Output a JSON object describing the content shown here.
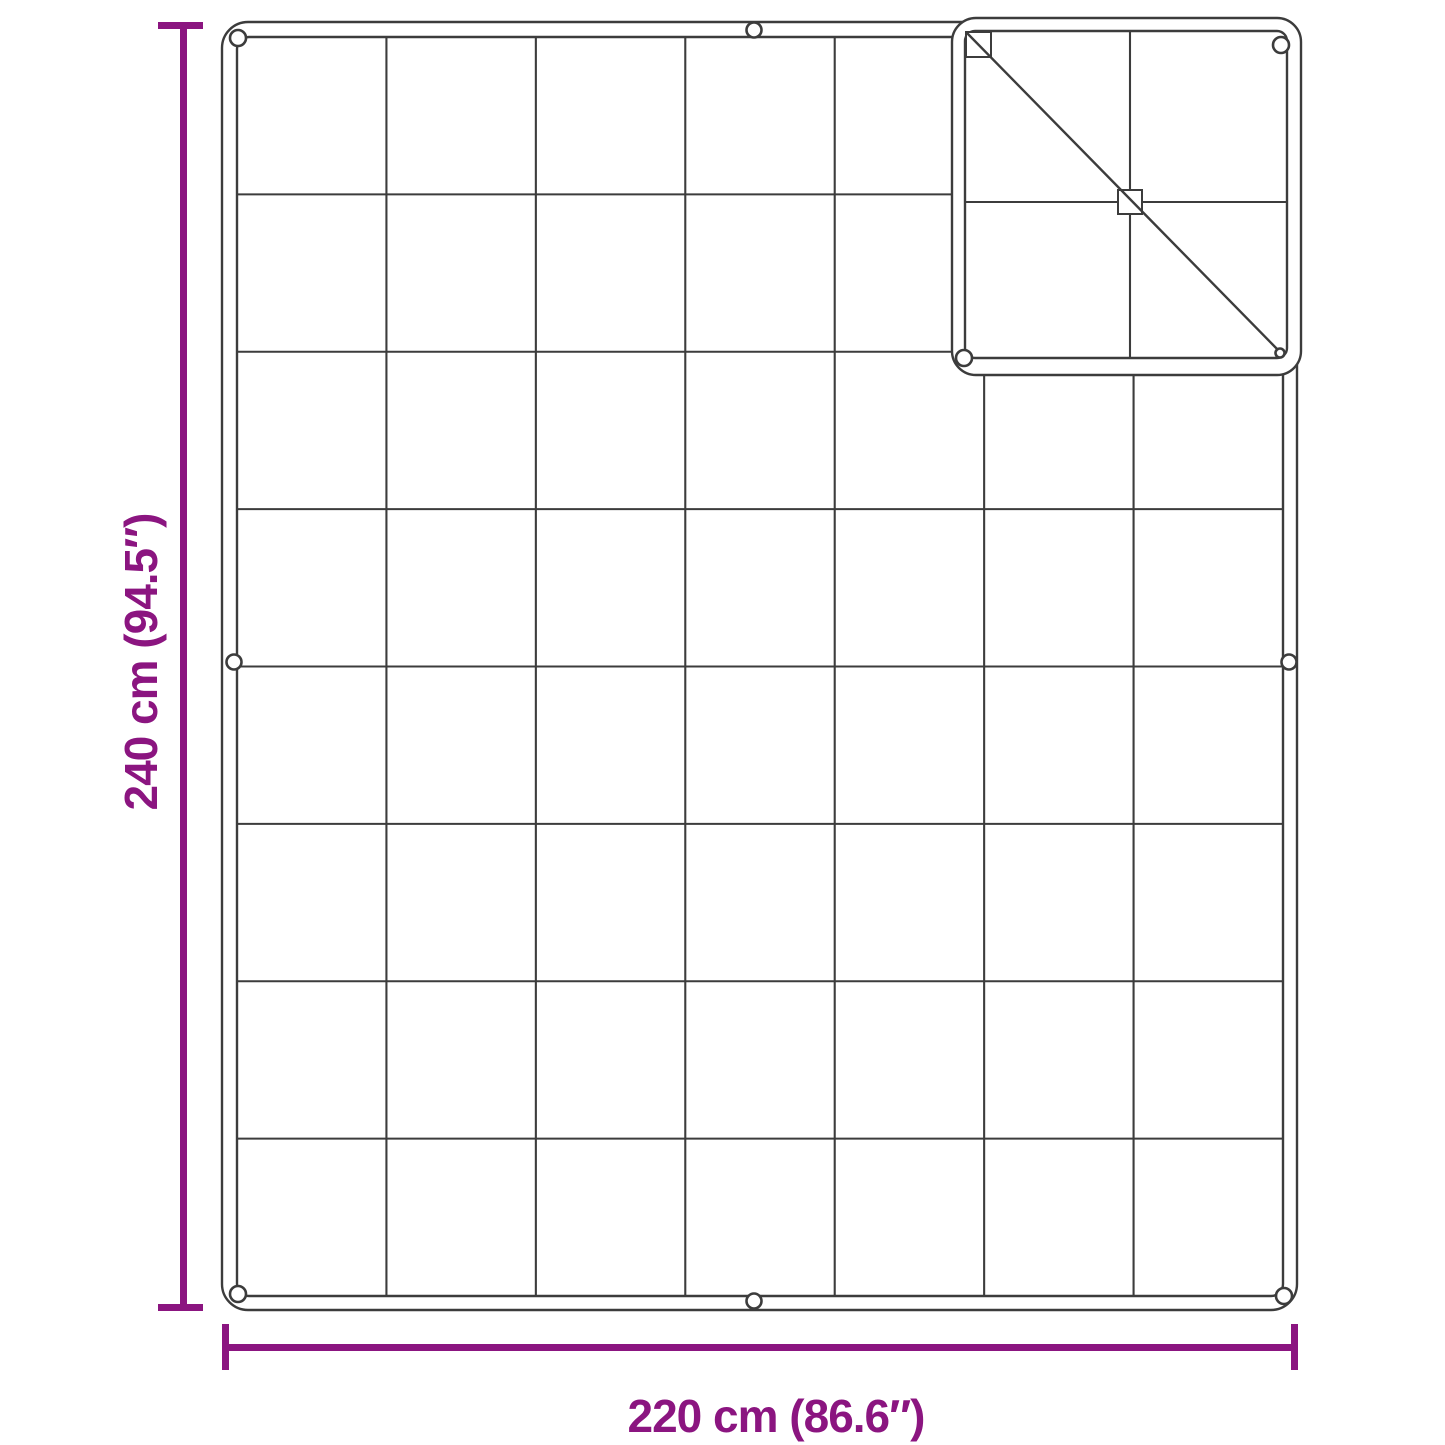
{
  "diagram": {
    "type": "product-dimension-line-drawing",
    "subject": "Quilted blanket / cover seen from above with stitched grid, edge eyelets and a folded-over top-right corner",
    "quilt_grid": {
      "columns": 7,
      "rows": 8
    },
    "eyelet_count": 10,
    "folded_corner": "top-right, showing reverse side with diagonal fold crease",
    "dimensions": {
      "height": {
        "label": "240 cm (94.5″)",
        "cm": 240,
        "inches": 94.5,
        "orientation": "vertical"
      },
      "width": {
        "label": "220 cm (86.6″)",
        "cm": 220,
        "inches": 86.6,
        "orientation": "horizontal"
      }
    }
  },
  "colors": {
    "accent": "#8B1580",
    "line": "#3C3C3C",
    "surface": "#FFFFFF"
  }
}
